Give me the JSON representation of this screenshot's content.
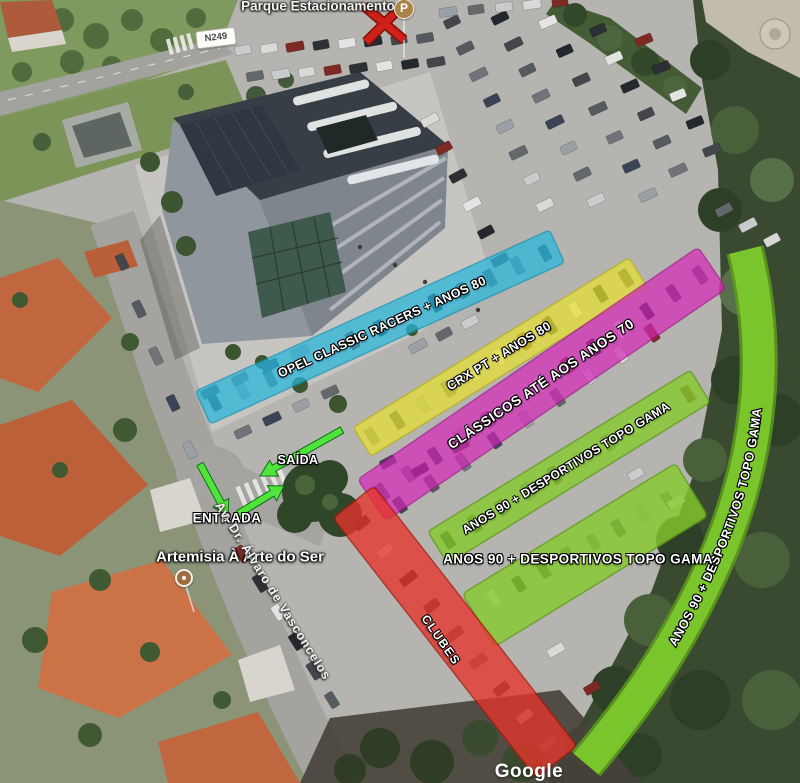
{
  "map": {
    "provider_watermark": "Google",
    "road_shield": "N249",
    "street_label": "Av. Dr. Álvaro de Vasconcelos",
    "place_label": "Artemisia À Arte do Ser",
    "parking_poi": {
      "label": "Parque Estacionamento",
      "icon_letter": "P",
      "crossed_out": true
    },
    "arrows": {
      "entrance": "ENTRADA",
      "exit": "SAÍDA"
    },
    "colors": {
      "zone_blue": "#27b7dc",
      "zone_yellow": "#e7e130",
      "zone_magenta": "#d627b8",
      "zone_green": "#86cb2e",
      "zone_red": "#e6352b",
      "arrow_green": "#4fe33c",
      "x_mark_red": "#cf201a"
    }
  },
  "zones": [
    {
      "id": "opel-classic-racers",
      "label": "OPEL CLASSIC RACERS + ANOS 80",
      "color": "#27b7dc"
    },
    {
      "id": "crx-pt",
      "label": "CRX PT + ANOS 80",
      "color": "#e7e130"
    },
    {
      "id": "classicos-ate-anos-70",
      "label": "CLÁSSICOS ATÉ AOS ANOS 70",
      "color": "#d627b8"
    },
    {
      "id": "anos-90-desportivos-upper",
      "label": "ANOS 90 + DESPORTIVOS TOPO GAMA",
      "color": "#86cb2e"
    },
    {
      "id": "anos-90-desportivos-lower",
      "label": "ANOS 90 + DESPORTIVOS TOPO GAMA",
      "color": "#86cb2e"
    },
    {
      "id": "clubes",
      "label": "CLUBES",
      "color": "#e6352b"
    },
    {
      "id": "anos-90-desportivos-curve",
      "label": "ANOS 90 + DESPORTIVOS TOPO GAMA",
      "color": "#7ecb2d"
    }
  ]
}
